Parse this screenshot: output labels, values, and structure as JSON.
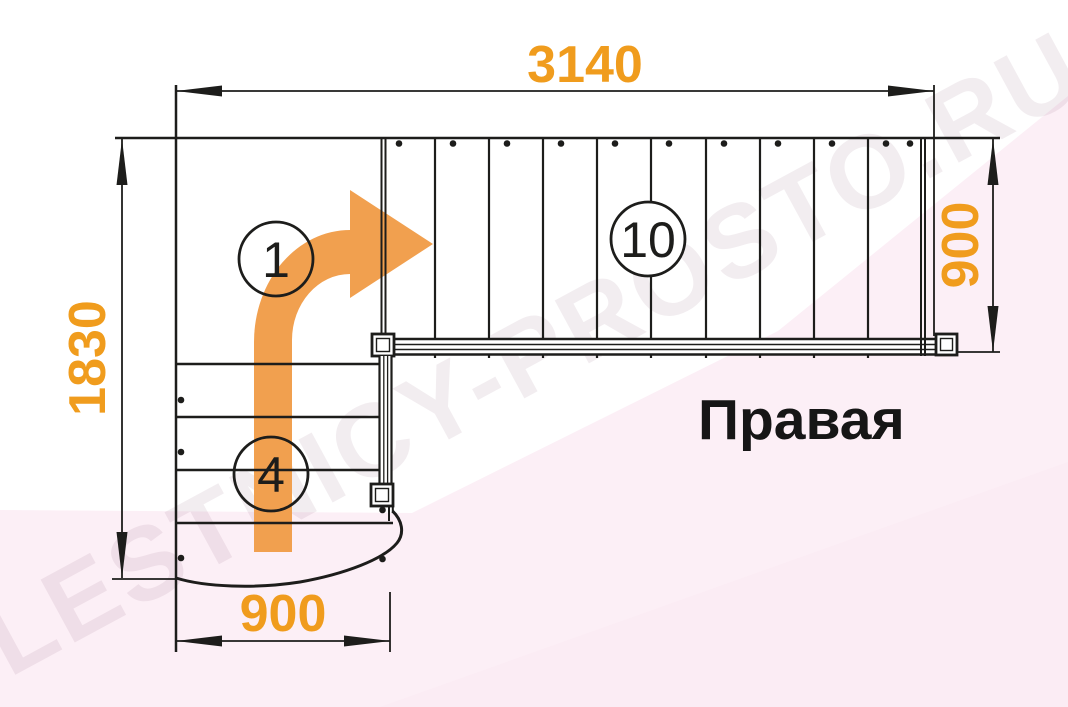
{
  "plan": {
    "orientation_label": "Правая",
    "watermark": "LESTNICY-PROSTO.RU",
    "dimensions": {
      "top_width": "3140",
      "left_height": "1830",
      "upper_flight_width": "900",
      "lower_flight_width": "900"
    },
    "step_labels": {
      "start_step": "1",
      "upper_flight_steps": "10",
      "lower_flight_steps": "4"
    },
    "colors": {
      "dimension_text": "#F09C1D",
      "arrow_fill": "#F1A04F",
      "line_color": "#1D1D1B",
      "background_pink": "#FCEFF6",
      "label_text": "#161616"
    }
  }
}
